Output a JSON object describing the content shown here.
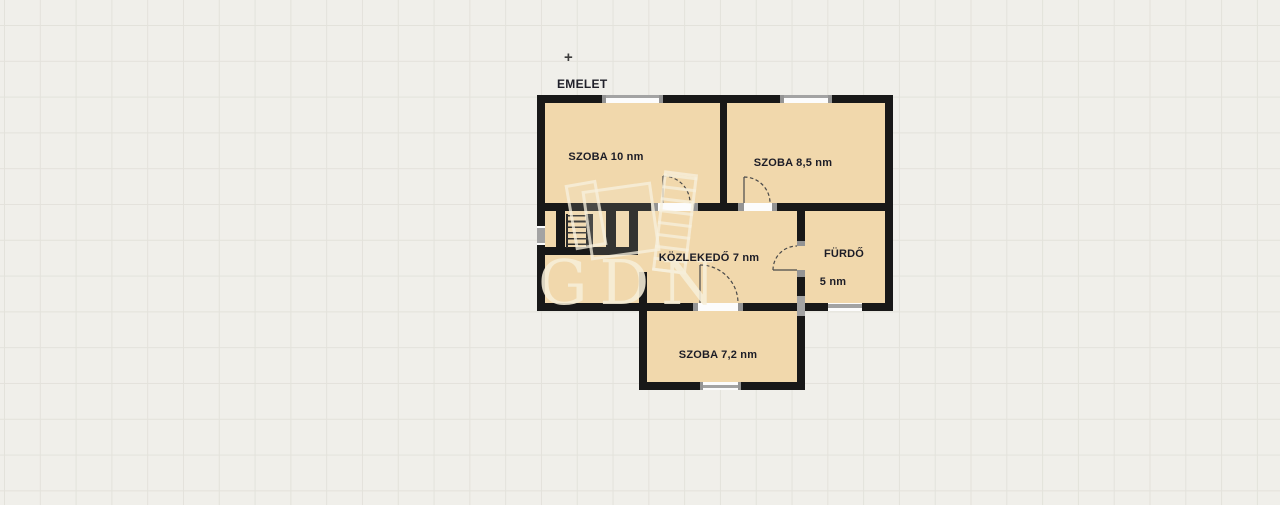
{
  "page": {
    "background_color": "#f0efea",
    "grid_color": "#e3e2db"
  },
  "plan": {
    "title": "EMELET",
    "marker": "+",
    "watermark": "GDN",
    "rooms": [
      {
        "id": "szoba-10",
        "label": "SZOBA 10 nm"
      },
      {
        "id": "szoba-85",
        "label": "SZOBA 8,5 nm"
      },
      {
        "id": "kozlekedo",
        "label": "KÖZLEKEDŐ 7 nm"
      },
      {
        "id": "furdo",
        "label": "FÜRDŐ",
        "area_label": "5 nm"
      },
      {
        "id": "szoba-72",
        "label": "SZOBA 7,2 nm"
      }
    ],
    "colors": {
      "room_fill": "#f1d8ac",
      "wall": "#181818",
      "window_gray": "#a3a3a3",
      "door_line": "#4a4a4a",
      "text": "#1c1c26",
      "watermark": "#f6eed8"
    }
  }
}
